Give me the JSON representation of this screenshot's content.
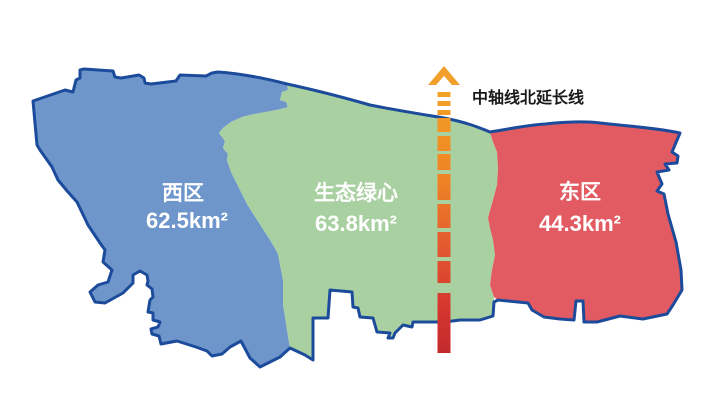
{
  "map": {
    "background": "#ffffff",
    "outline_color": "#1c4b9b",
    "label_color": "#ffffff"
  },
  "regions": {
    "west": {
      "name": "西区",
      "area": "62.5km²",
      "fill": "#6e96cb"
    },
    "green_heart": {
      "name": "生态绿心",
      "area": "63.8km²",
      "fill": "#a9d0a1"
    },
    "east": {
      "name": "东区",
      "area": "44.3km²",
      "fill": "#e25b62"
    }
  },
  "axis": {
    "label": "中轴线北延长线",
    "label_color": "#1a1a1a",
    "arrow_color": "#f0a02b",
    "gradient": {
      "top": "#f2a227",
      "upper_mid": "#ee8125",
      "mid": "#e25530",
      "lower_mid": "#d5372f",
      "bottom": "#c42a2d"
    }
  }
}
